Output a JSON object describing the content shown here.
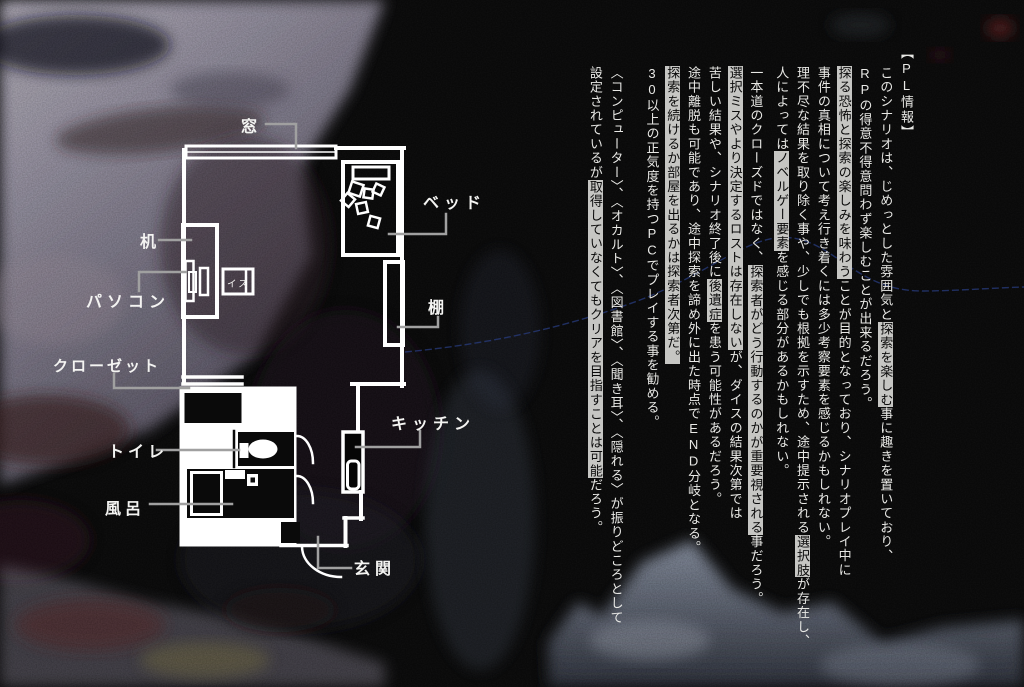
{
  "colors": {
    "background": "#050505",
    "plan_line": "#ffffff",
    "leader_line": "#a0a0a0",
    "text": "#e8e8e5",
    "highlight_bg": "#c6c6c3",
    "highlight_text": "#0b0b0b",
    "accent_blue_line": "#2a3f86"
  },
  "plan": {
    "labels": {
      "window": "窓",
      "bed": "ベッド",
      "desk": "机",
      "pc": "パソコン",
      "closet": "クローゼット",
      "toilet": "トイレ",
      "bath": "風呂",
      "kitchen": "キッチン",
      "entrance": "玄関",
      "shelf": "棚",
      "chair": "イス"
    }
  },
  "text_block": {
    "header": "【PL情報】",
    "paragraphs": [
      {
        "columns": [
          {
            "segments": [
              {
                "t": "【"
              },
              {
                "t": "PL",
                "u": 1
              },
              {
                "t": "情報】"
              }
            ]
          },
          {
            "segments": [
              {
                "t": "このシナリオは、じめっとした雰囲気と"
              },
              {
                "t": "探索を楽しむ",
                "h": 1
              },
              {
                "t": "事に趣きを置いており、"
              }
            ]
          },
          {
            "segments": [
              {
                "t": "RP",
                "u": 1
              },
              {
                "t": "の得意不得意問わず楽しむことが出来るだろう。"
              }
            ]
          },
          {
            "segments": [
              {
                "t": "探る恐怖と探索の楽しみを味わう",
                "h": 1
              },
              {
                "t": "ことが目的となっており、シナリオプレイ中に"
              }
            ]
          },
          {
            "segments": [
              {
                "t": "事件の真相について考え行き着くには多少考察要素を感じるかもしれない。"
              }
            ]
          },
          {
            "segments": [
              {
                "t": "理不尽な結果を取り除く事や、少しでも根拠を示すため、途中提示される"
              },
              {
                "t": "選択肢",
                "h": 1
              },
              {
                "t": "が存在し、"
              }
            ]
          },
          {
            "segments": [
              {
                "t": "人によっては"
              },
              {
                "t": "ノベルゲー要素",
                "h": 1
              },
              {
                "t": "を感じる部分があるかもしれない。"
              }
            ]
          }
        ]
      },
      {
        "columns": [
          {
            "segments": [
              {
                "t": "一本道のクローズドではなく、"
              },
              {
                "t": "探索者がどう行動するのかが重要視される",
                "h": 1
              },
              {
                "t": "事だろう。"
              }
            ]
          },
          {
            "segments": [
              {
                "t": "選択ミスやより決定するロストは存在しない",
                "h": 1
              },
              {
                "t": "が、ダイスの結果次第では"
              }
            ]
          },
          {
            "segments": [
              {
                "t": "苦しい結果や、シナリオ終了後に"
              },
              {
                "t": "後遺症",
                "h": 1
              },
              {
                "t": "を患う可能性があるだろう。"
              }
            ]
          },
          {
            "segments": [
              {
                "t": "途中離脱も可能であり、途中探索を諦め外に出た時点で"
              },
              {
                "t": "END",
                "u": 1
              },
              {
                "t": "分岐となる。"
              }
            ]
          },
          {
            "segments": [
              {
                "t": "探索を続けるか部屋を出るかは探索者次第だ。",
                "h": 1
              }
            ]
          },
          {
            "segments": [
              {
                "t": "30",
                "u": 1
              },
              {
                "t": "以上の正気度を持つ"
              },
              {
                "t": "PC",
                "u": 1
              },
              {
                "t": "でプレイする事を勧める。"
              }
            ]
          }
        ]
      },
      {
        "columns": [
          {
            "segments": [
              {
                "t": "〈コンピューター〉、〈オカルト〉、〈図書館〉、〈聞き耳〉、〈隠れる〉が振りどころとして"
              }
            ]
          },
          {
            "segments": [
              {
                "t": "設定されているが"
              },
              {
                "t": "取得していなくてもクリアを目指すことは可能",
                "h": 1
              },
              {
                "t": "だろう。"
              }
            ]
          }
        ]
      }
    ]
  }
}
